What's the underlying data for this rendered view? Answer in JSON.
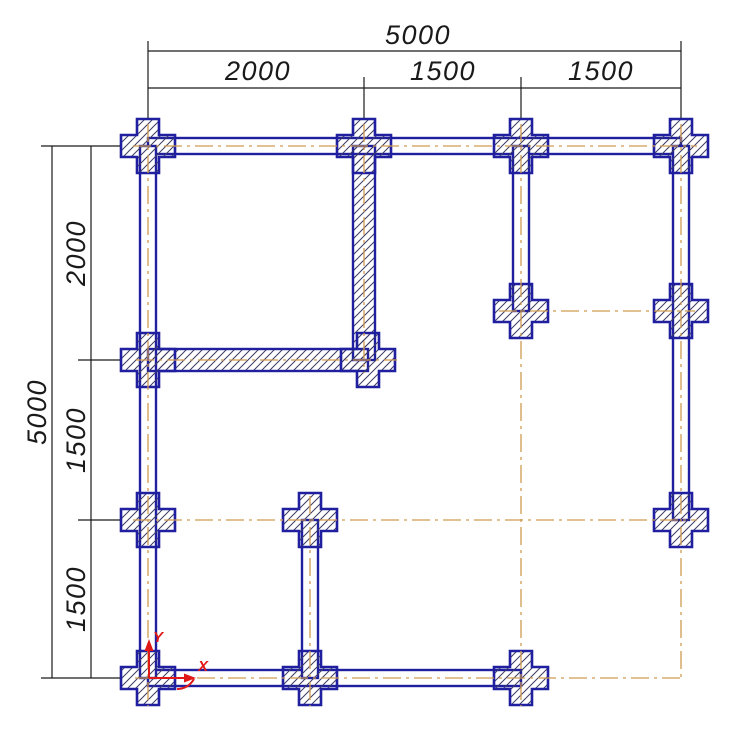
{
  "drawing": {
    "colors": {
      "outline": "#1f1fa0",
      "hatch_line": "#3c3c64",
      "centerline": "#cf9a50",
      "dimension": "#1a1a1a",
      "ucs": "#e01818",
      "background": "#ffffff"
    },
    "dimensions": {
      "top": {
        "overall": "5000",
        "segments": [
          "2000",
          "1500",
          "1500"
        ]
      },
      "left": {
        "overall": "5000",
        "segments": [
          "2000",
          "1500",
          "1500"
        ]
      }
    },
    "ucs": {
      "x_label": "X",
      "y_label": "Y"
    }
  }
}
